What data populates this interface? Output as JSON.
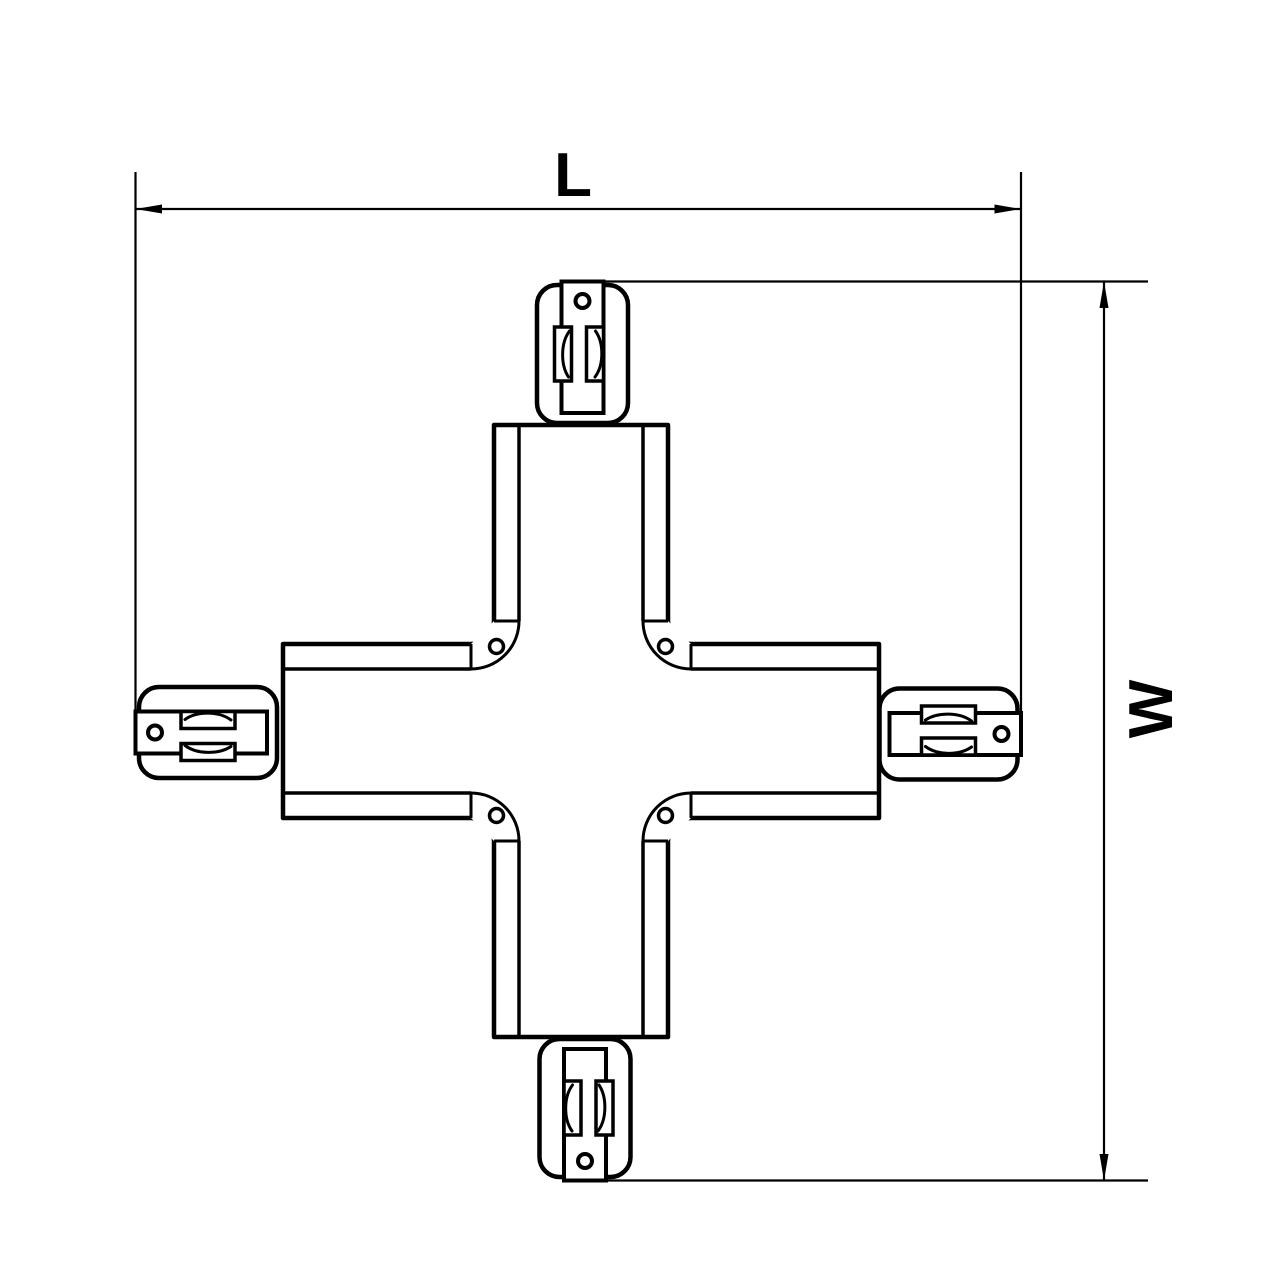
{
  "page": {
    "background": "#ffffff",
    "line_color": "#000000"
  },
  "drawing": {
    "kind": "technical-dimension-drawing",
    "part": "x-shaped track connector (4-way cross coupler), top view",
    "connector_count": 4,
    "screw_count": 4,
    "connector_positions": [
      "top",
      "right",
      "bottom",
      "left"
    ]
  },
  "dimensions": {
    "length_label": "L",
    "width_label": "W"
  }
}
